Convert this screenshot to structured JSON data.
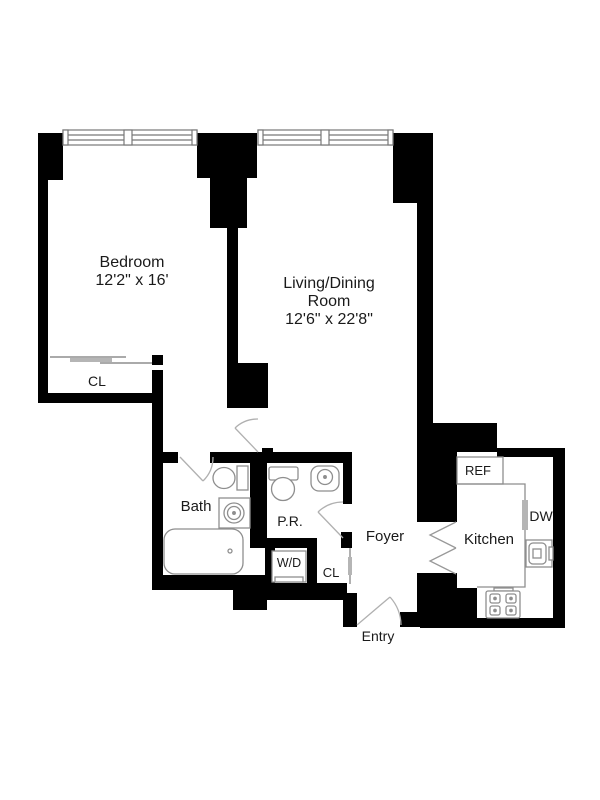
{
  "plan": {
    "rooms": {
      "bedroom": {
        "name": "Bedroom",
        "dims": "12'2\" x 16'"
      },
      "living_dining": {
        "name_line1": "Living/Dining",
        "name_line2": "Room",
        "dims": "12'6\" x 22'8\""
      },
      "bath": {
        "name": "Bath"
      },
      "powder_room": {
        "name": "P.R."
      },
      "foyer": {
        "name": "Foyer"
      },
      "kitchen": {
        "name": "Kitchen"
      },
      "entry": {
        "name": "Entry"
      },
      "bedroom_closet": {
        "name": "CL"
      },
      "foyer_closet": {
        "name": "CL"
      }
    },
    "fixtures": {
      "washer_dryer": {
        "label": "W/D"
      },
      "refrigerator": {
        "label": "REF"
      },
      "dishwasher": {
        "label": "DW"
      }
    },
    "colors": {
      "wall": "#000000",
      "label": "#1a1a1a",
      "fixture_stroke": "#8e8e8e",
      "door_stroke": "#b0b0b0",
      "background": "#ffffff"
    }
  }
}
